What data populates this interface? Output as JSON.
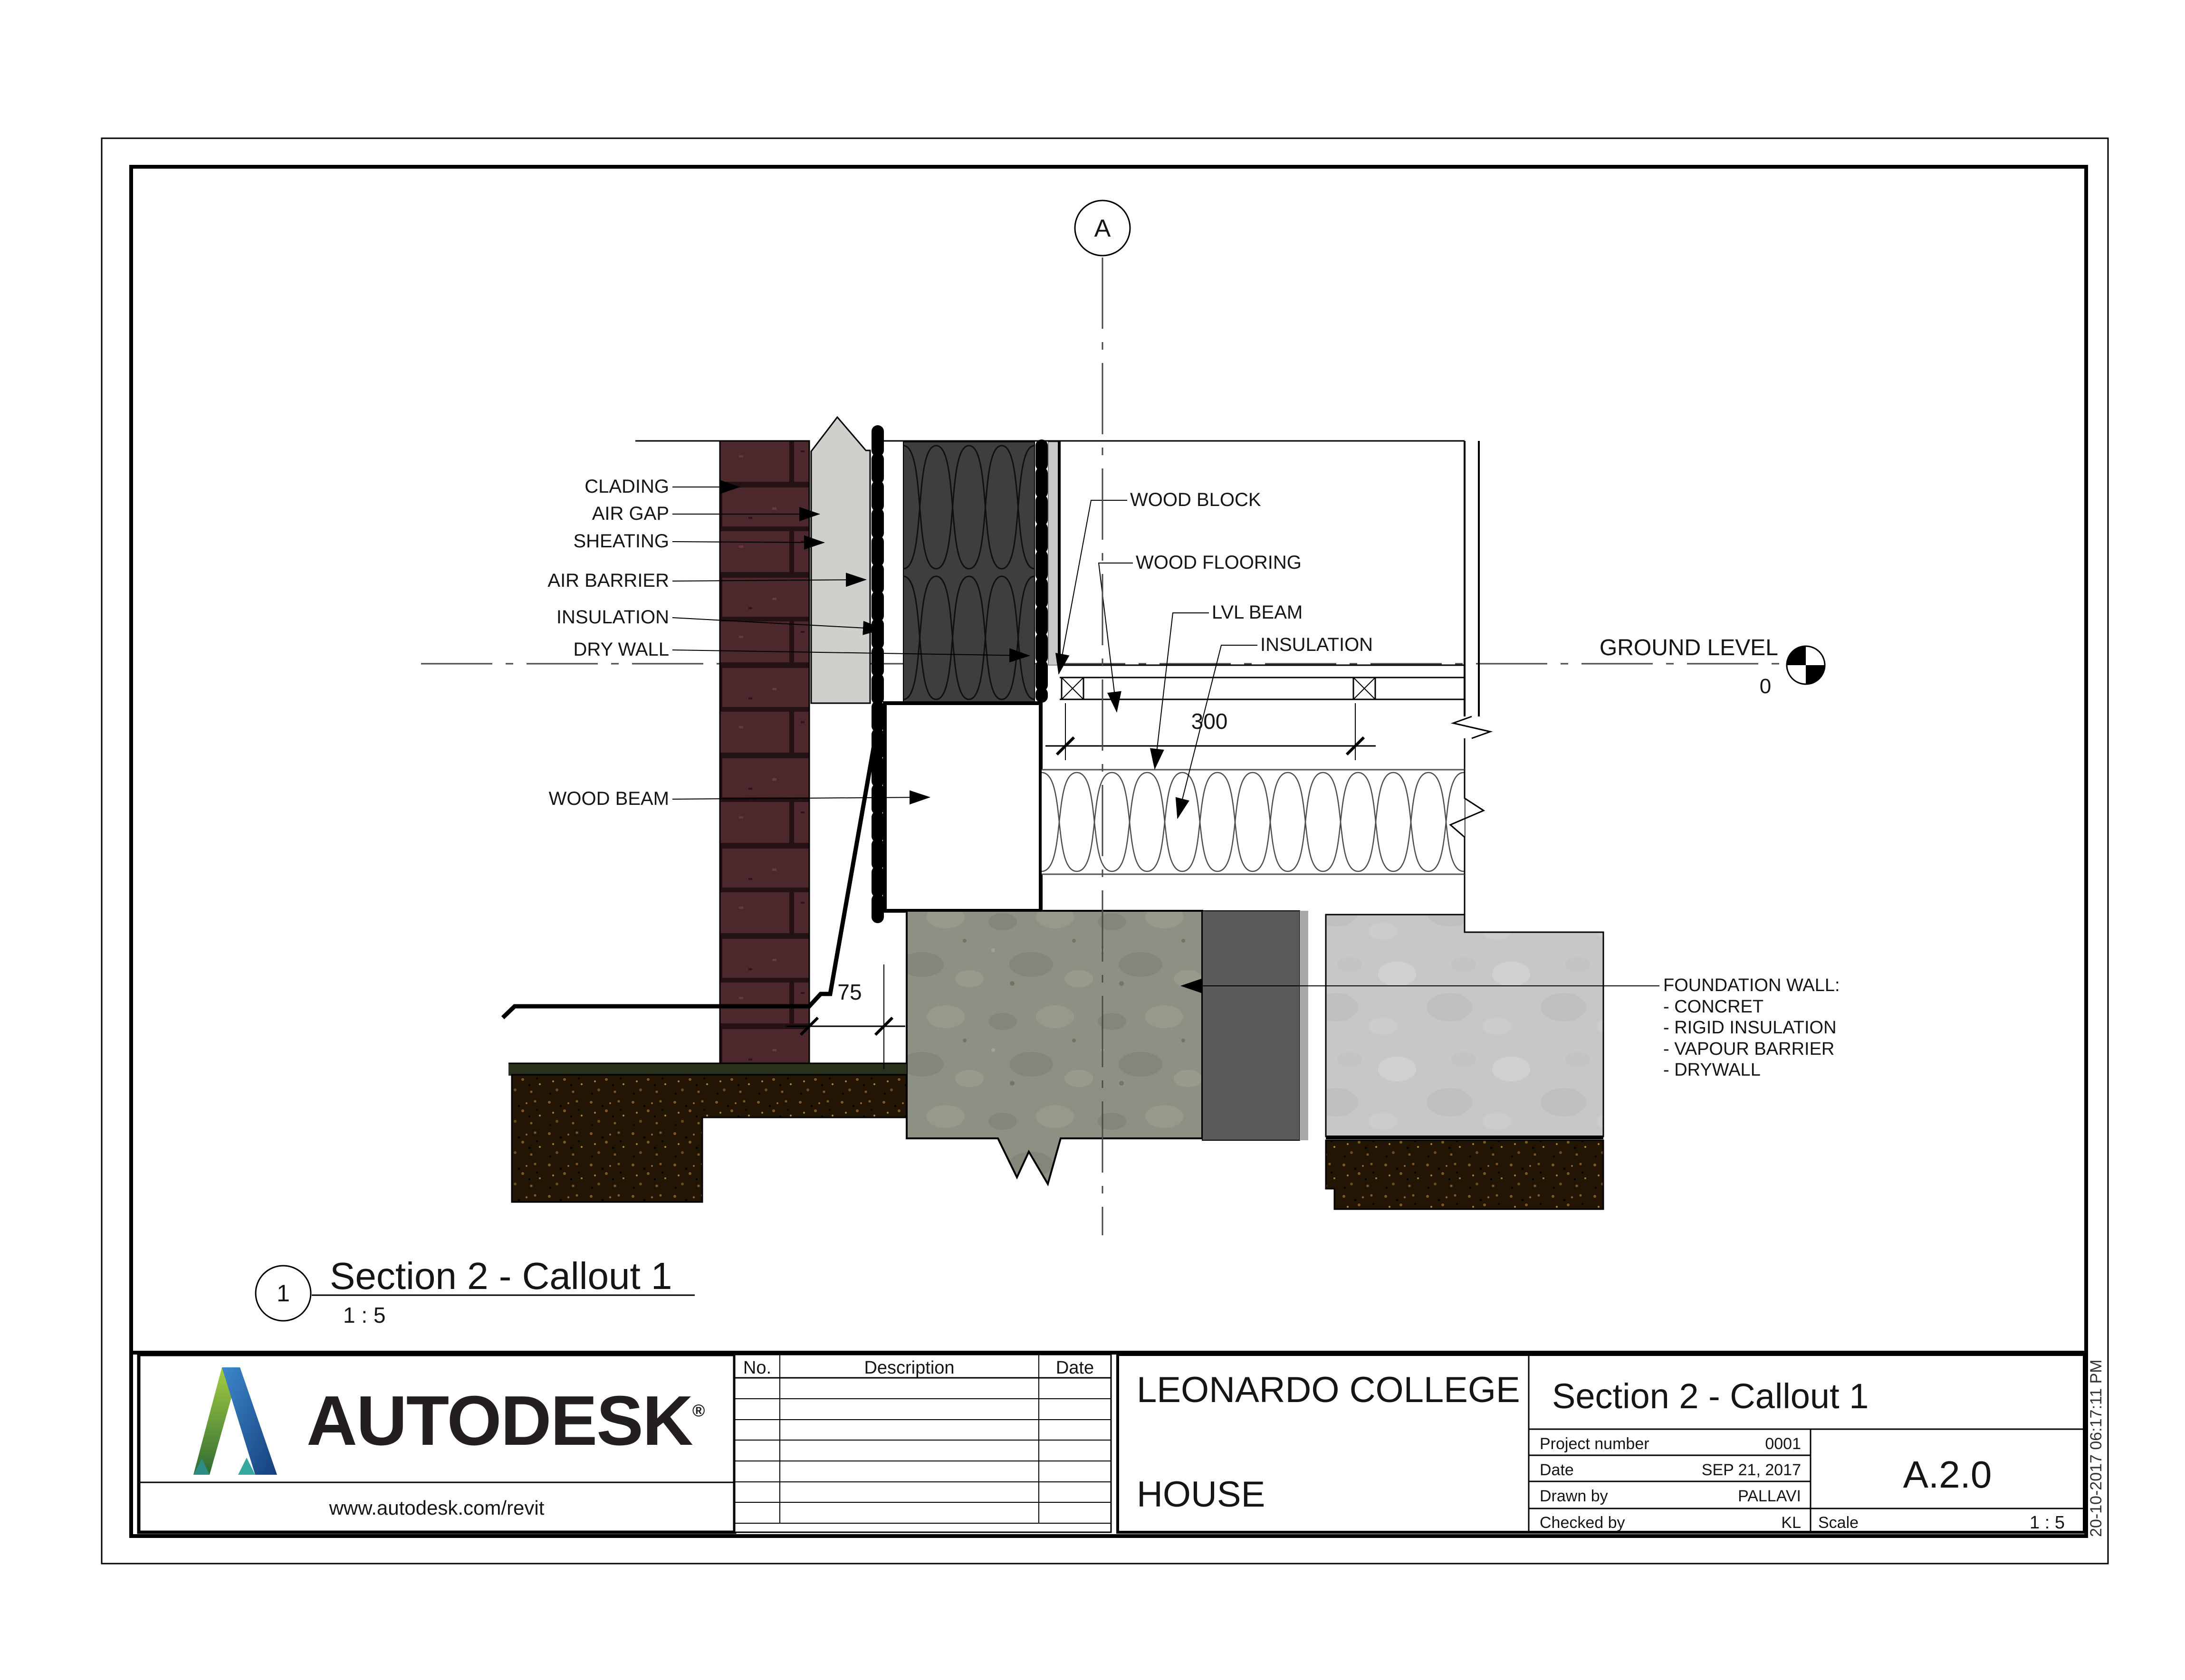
{
  "drawing": {
    "grid_bubble": "A",
    "ground_level": {
      "label": "GROUND LEVEL",
      "value": "0"
    },
    "left_labels": [
      "CLADING",
      "AIR GAP",
      "SHEATING",
      "AIR BARRIER",
      "INSULATION",
      "DRY WALL"
    ],
    "wood_beam_label": "WOOD BEAM",
    "right_labels": [
      "WOOD BLOCK",
      "WOOD FLOORING",
      "LVL BEAM",
      "INSULATION"
    ],
    "dimensions": {
      "floor_width": "300",
      "wall_offset": "75"
    },
    "foundation_note": {
      "title": "FOUNDATION WALL:",
      "items": [
        "- CONCRET",
        "- RIGID INSULATION",
        "- VAPOUR BARRIER",
        "- DRYWALL"
      ]
    }
  },
  "view_title": {
    "number": "1",
    "title": "Section 2 - Callout 1",
    "scale": "1 : 5"
  },
  "title_block": {
    "logo": {
      "brand": "AUTODESK",
      "registered": "®",
      "url": "www.autodesk.com/revit"
    },
    "revision_table": {
      "columns": [
        "No.",
        "Description",
        "Date"
      ],
      "row_count": 7
    },
    "project": {
      "client": "LEONARDO COLLEGE",
      "name": "HOUSE"
    },
    "sheet": {
      "title": "Section 2 - Callout 1",
      "fields": [
        {
          "label": "Project number",
          "value": "0001"
        },
        {
          "label": "Date",
          "value": "SEP 21, 2017"
        },
        {
          "label": "Drawn by",
          "value": "PALLAVI"
        },
        {
          "label": "Checked by",
          "value": "KL"
        }
      ],
      "number": "A.2.0",
      "scale_label": "Scale",
      "scale_value": "1 : 5"
    },
    "timestamp": "20-10-2017 06:17:11 PM"
  }
}
